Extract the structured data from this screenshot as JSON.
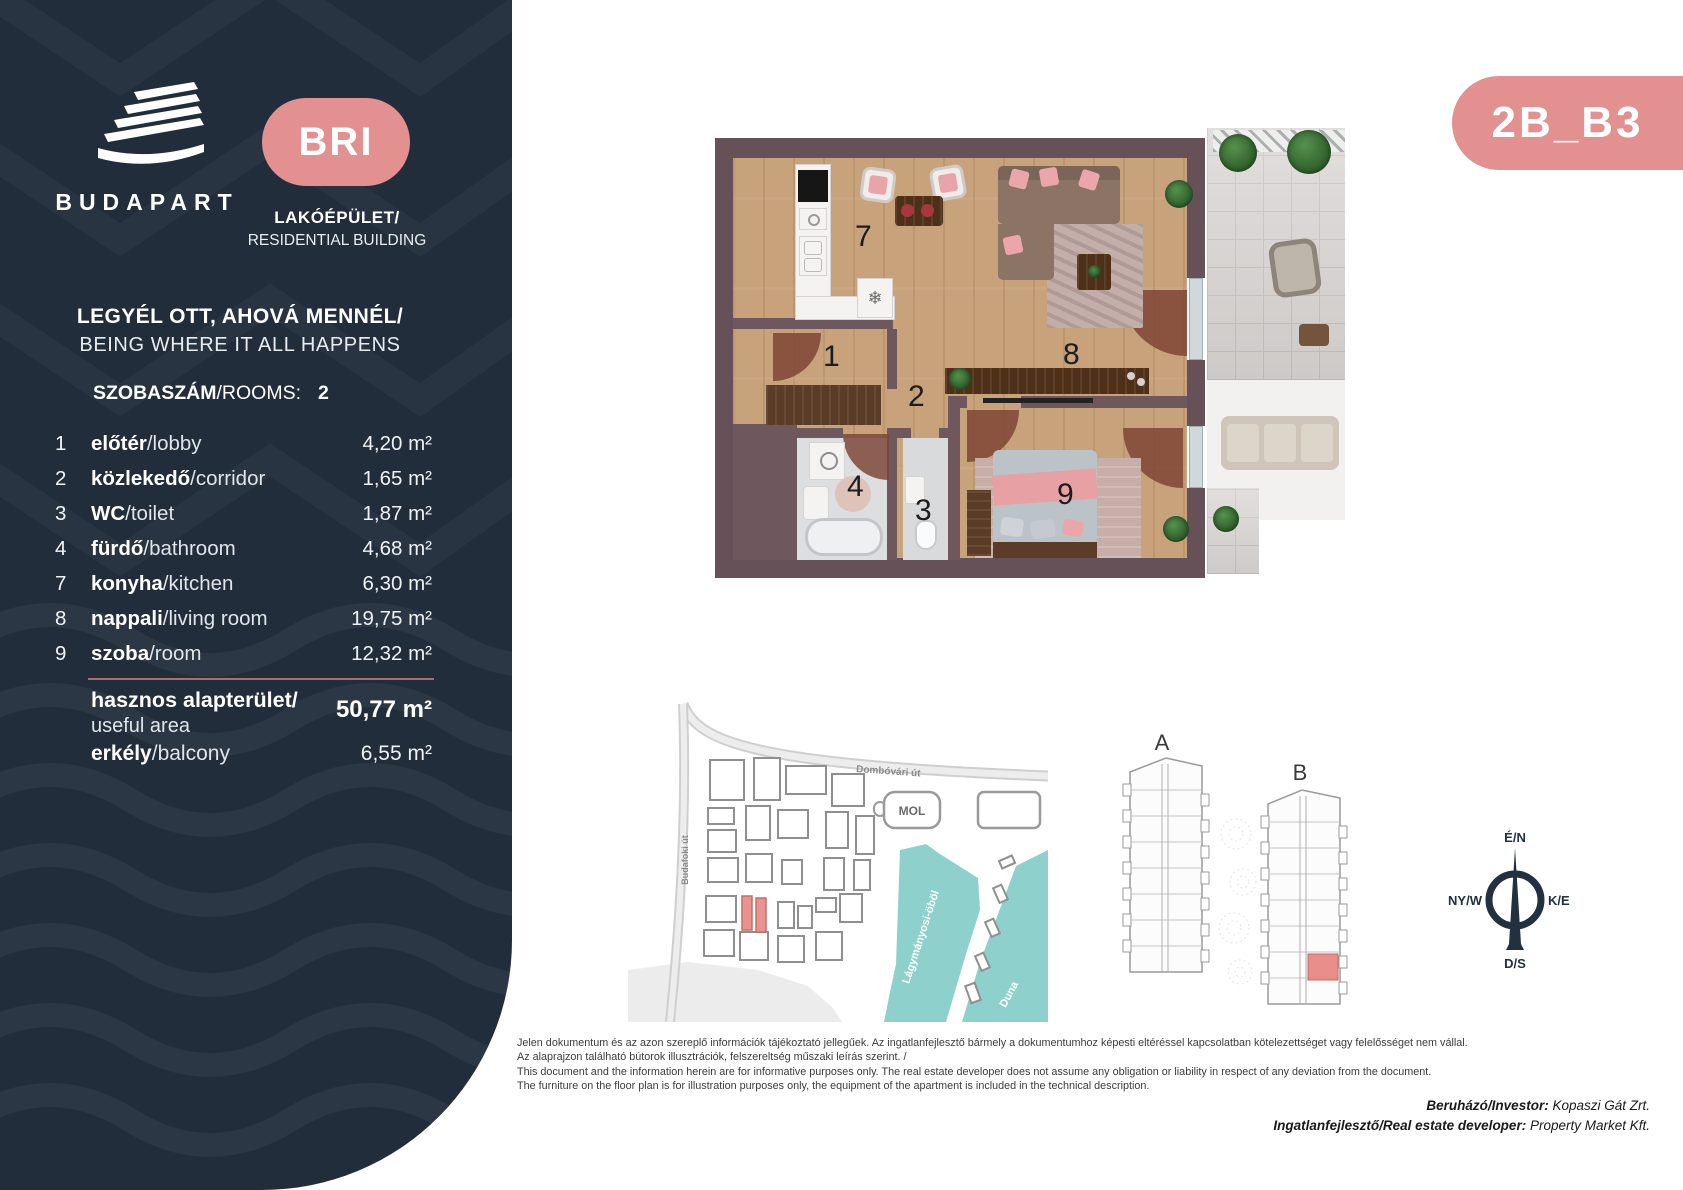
{
  "sidebar": {
    "brand": "BUDAPART",
    "badge": "BRI",
    "building_type_hu": "LAKÓÉPÜLET/",
    "building_type_en": "RESIDENTIAL BUILDING",
    "tagline_hu": "LEGYÉL OTT, AHOVÁ MENNÉL/",
    "tagline_en": "BEING WHERE IT ALL HAPPENS",
    "rooms_label_hu": "SZOBASZÁM",
    "rooms_label_en": "/ROOMS:",
    "rooms_count": "2",
    "bg": "#212D3B",
    "accent": "#E29190"
  },
  "unit_code": "2B_B3",
  "rooms": [
    {
      "no": "1",
      "hu": "előtér",
      "en": "/lobby",
      "area": "4,20 m²"
    },
    {
      "no": "2",
      "hu": "közlekedő",
      "en": "/corridor",
      "area": "1,65 m²"
    },
    {
      "no": "3",
      "hu": "WC",
      "en": "/toilet",
      "area": "1,87 m²"
    },
    {
      "no": "4",
      "hu": "fürdő",
      "en": "/bathroom",
      "area": "4,68 m²"
    },
    {
      "no": "7",
      "hu": "konyha",
      "en": "/kitchen",
      "area": "6,30 m²"
    },
    {
      "no": "8",
      "hu": "nappali",
      "en": "/living room",
      "area": "19,75 m²"
    },
    {
      "no": "9",
      "hu": "szoba",
      "en": "/room",
      "area": "12,32 m²"
    }
  ],
  "totals": {
    "useful_hu": "hasznos alapterület/",
    "useful_en": "useful area",
    "useful_value": "50,77 m²",
    "balcony_hu": "erkély",
    "balcony_en": "/balcony",
    "balcony_value": "6,55 m²"
  },
  "map": {
    "road_top": "Dombóvári út",
    "road_left": "Budafoki út",
    "station": "MOL",
    "bay": "Lágymányosi-öböl",
    "river": "Duna",
    "water_color": "#8ED1CC",
    "highlight_color": "#E8938F"
  },
  "buildings": {
    "a": "A",
    "b": "B"
  },
  "compass": {
    "n": "É/N",
    "w": "NY/W",
    "e": "K/E",
    "s": "D/S"
  },
  "disclaimer": [
    "Jelen dokumentum és az azon szereplő információk tájékoztató jellegűek. Az ingatlanfejlesztő bármely a dokumentumhoz képesti eltéréssel kapcsolatban kötelezettséget vagy felelősséget nem vállal.",
    "Az alaprajzon található bútorok illusztrációk, felszereltség műszaki leírás szerint. /",
    "This document and the information herein are for informative purposes only. The real estate developer does not assume any obligation or liability in respect of any deviation from the document.",
    "The furniture on the floor plan is for illustration purposes only, the equipment of the apartment is included in the technical description."
  ],
  "credits": {
    "investor_label": "Beruházó/Investor:",
    "investor_value": " Kopaszi Gát Zrt.",
    "developer_label": "Ingatlanfejlesztő/Real estate developer:",
    "developer_value": " Property Market Kft."
  }
}
